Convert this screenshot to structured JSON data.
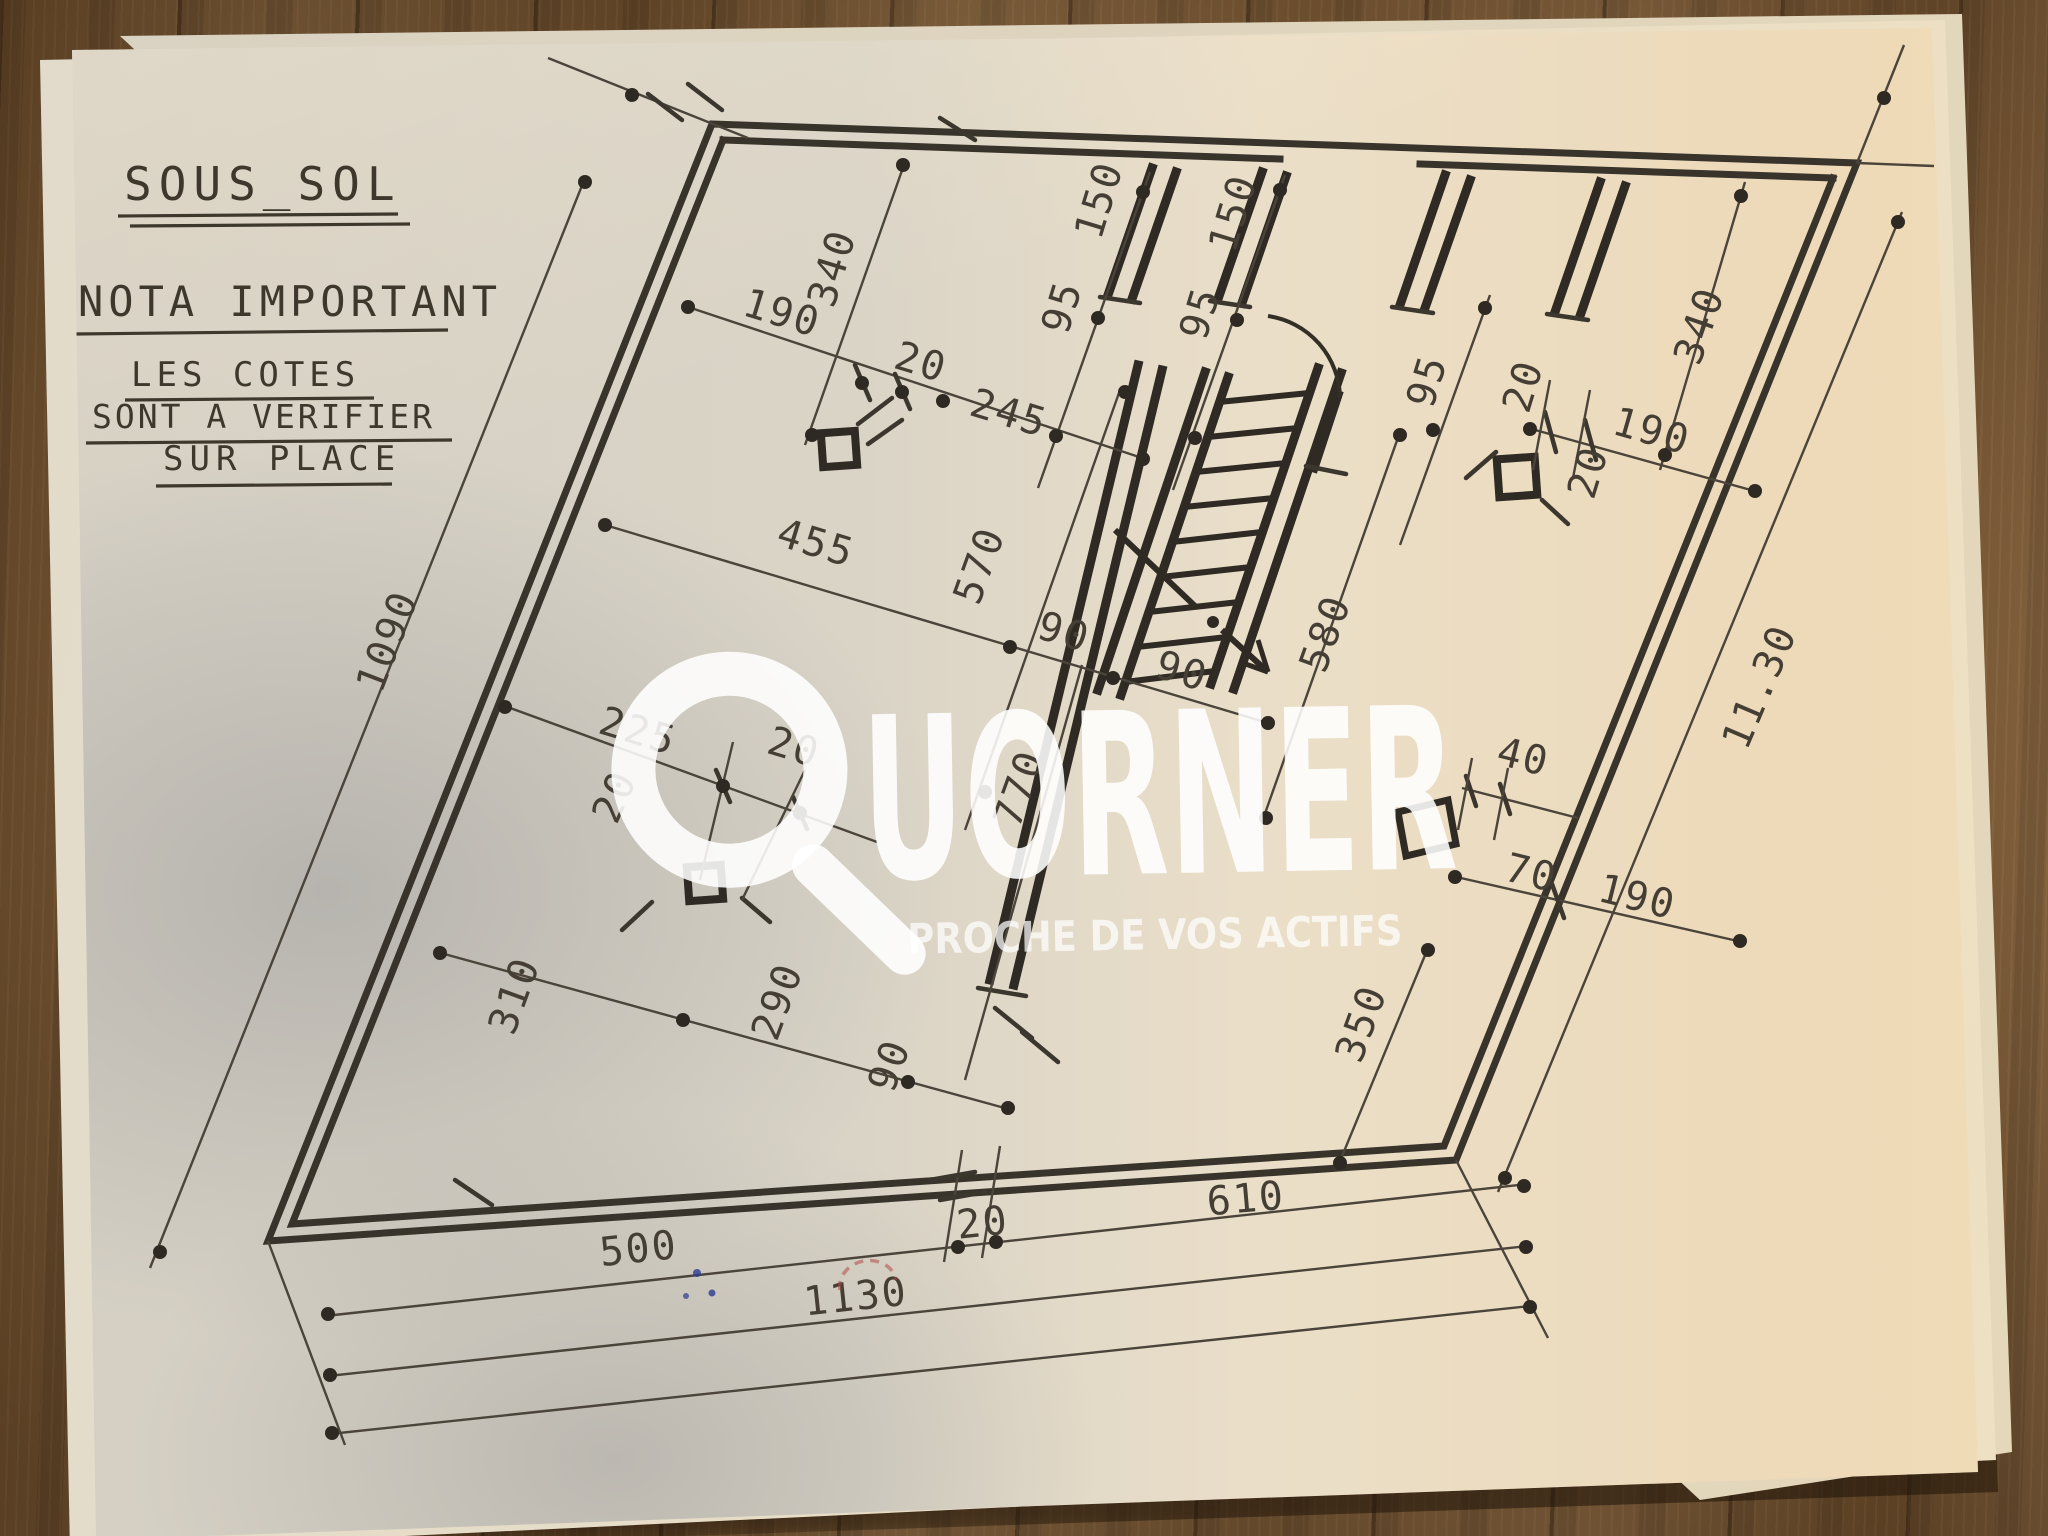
{
  "notes": {
    "title": "SOUS_SOL",
    "subtitle": "NOTA IMPORTANT",
    "body_line1": "LES COTES",
    "body_line2": "SONT A VERIFIER",
    "body_line3": "SUR PLACE"
  },
  "watermark": {
    "brand": "QUORNER",
    "brand_rest": "UORNER",
    "logo_icon": "magnifier-q-icon",
    "tagline": "PROCHE DE VOS ACTIFS"
  },
  "plan": {
    "drawing_type": "basement floor plan",
    "dimensions": [
      {
        "value": "340",
        "x": 845,
        "y": 272,
        "rot": -73
      },
      {
        "value": "190",
        "x": 778,
        "y": 326,
        "rot": 17
      },
      {
        "value": "20",
        "x": 917,
        "y": 375,
        "rot": 17
      },
      {
        "value": "245",
        "x": 1005,
        "y": 426,
        "rot": 17
      },
      {
        "value": "150",
        "x": 1112,
        "y": 204,
        "rot": -73
      },
      {
        "value": "95",
        "x": 1075,
        "y": 311,
        "rot": -73
      },
      {
        "value": "150",
        "x": 1246,
        "y": 217,
        "rot": -73
      },
      {
        "value": "95",
        "x": 1213,
        "y": 317,
        "rot": -73
      },
      {
        "value": "95",
        "x": 1440,
        "y": 385,
        "rot": -73
      },
      {
        "value": "20",
        "x": 1536,
        "y": 390,
        "rot": -73
      },
      {
        "value": "190",
        "x": 1648,
        "y": 444,
        "rot": 16
      },
      {
        "value": "20",
        "x": 1601,
        "y": 476,
        "rot": -73
      },
      {
        "value": "340",
        "x": 1712,
        "y": 330,
        "rot": -71
      },
      {
        "value": "455",
        "x": 812,
        "y": 556,
        "rot": 17
      },
      {
        "value": "570",
        "x": 992,
        "y": 570,
        "rot": -70
      },
      {
        "value": "1090",
        "x": 400,
        "y": 646,
        "rot": -69
      },
      {
        "value": "90",
        "x": 1060,
        "y": 645,
        "rot": 17
      },
      {
        "value": "90",
        "x": 1178,
        "y": 684,
        "rot": 17
      },
      {
        "value": "580",
        "x": 1338,
        "y": 638,
        "rot": -70
      },
      {
        "value": "11.30",
        "x": 1772,
        "y": 692,
        "rot": -67
      },
      {
        "value": "225",
        "x": 634,
        "y": 744,
        "rot": 17
      },
      {
        "value": "20",
        "x": 627,
        "y": 802,
        "rot": -66
      },
      {
        "value": "20",
        "x": 790,
        "y": 760,
        "rot": 17
      },
      {
        "value": "770",
        "x": 1032,
        "y": 793,
        "rot": -70
      },
      {
        "value": "40",
        "x": 1520,
        "y": 770,
        "rot": 14
      },
      {
        "value": "70",
        "x": 1528,
        "y": 886,
        "rot": 14
      },
      {
        "value": "190",
        "x": 1634,
        "y": 910,
        "rot": 14
      },
      {
        "value": "350",
        "x": 1374,
        "y": 1028,
        "rot": -70
      },
      {
        "value": "310",
        "x": 527,
        "y": 1000,
        "rot": -70
      },
      {
        "value": "290",
        "x": 790,
        "y": 1006,
        "rot": -70
      },
      {
        "value": "90",
        "x": 902,
        "y": 1070,
        "rot": -70
      },
      {
        "value": "610",
        "x": 1247,
        "y": 1212,
        "rot": -5
      },
      {
        "value": "500",
        "x": 640,
        "y": 1262,
        "rot": -6
      },
      {
        "value": "20",
        "x": 984,
        "y": 1236,
        "rot": -6
      },
      {
        "value": "1130",
        "x": 857,
        "y": 1310,
        "rot": -6
      }
    ]
  },
  "colors": {
    "ink": "#443e34",
    "paper": "#e7e0d0",
    "wood": "#83613c",
    "watermark": "#ffffff"
  }
}
